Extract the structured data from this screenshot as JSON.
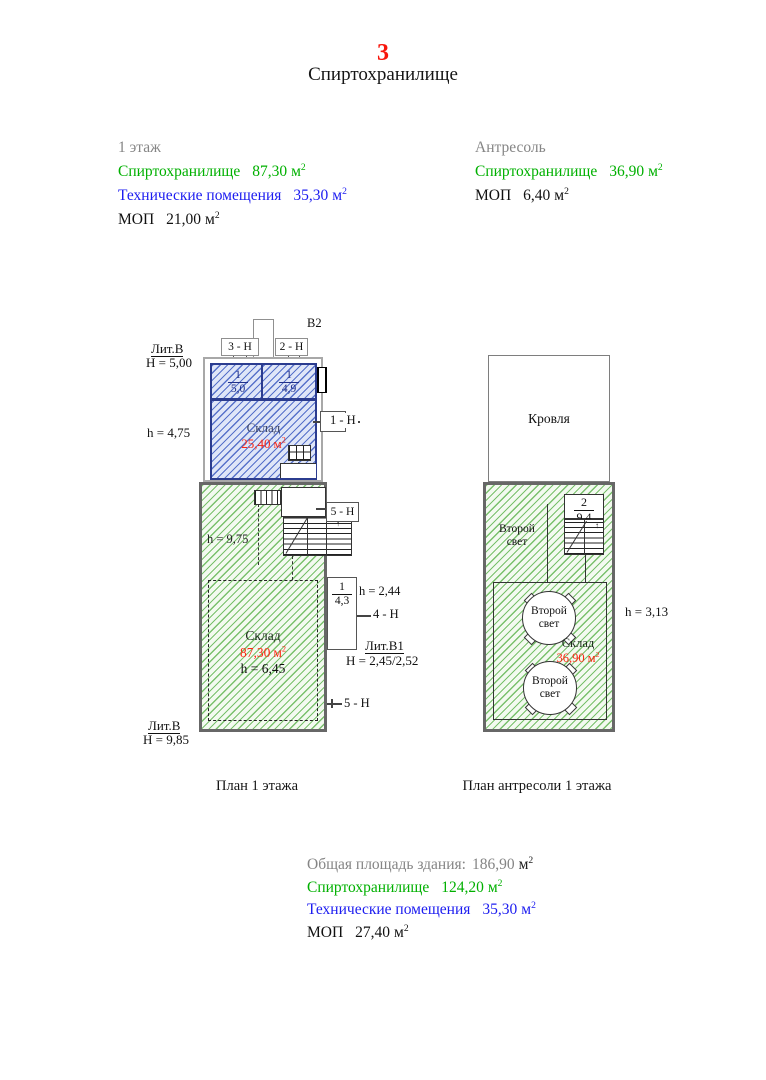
{
  "colors": {
    "accent_green": "#00b000",
    "accent_blue": "#1c1cf0",
    "accent_red": "#ff2613",
    "page_number_red": "#f8150b",
    "muted_gray": "#858585",
    "plan_blue": "#2b3c8f"
  },
  "header": {
    "page_number": "3",
    "title": "Спиртохранилище"
  },
  "units": {
    "base": "м",
    "sup": "2"
  },
  "legend_floor1": {
    "heading": "1 этаж",
    "alcohol_label": "Спиртохранилище",
    "alcohol_value": "87,30",
    "tech_label": "Технические помещения",
    "tech_value": "35,30",
    "mop_label": "МОП",
    "mop_value": "21,00"
  },
  "legend_mezzanine": {
    "heading": "Антресоль",
    "alcohol_label": "Спиртохранилище",
    "alcohol_value": "36,90",
    "mop_label": "МОП",
    "mop_value": "6,40"
  },
  "plan1": {
    "caption": "План 1 этажа",
    "vent": "В2",
    "lit_top_name": "Лит.В",
    "lit_top_h": "Н = 5,00",
    "h_left": "h = 4,75",
    "marker_3n": "3 - Н",
    "marker_2n": "2 - Н",
    "marker_1n": "1 - Н",
    "marker_5n_up": "5 - Н",
    "marker_4n": "4 - Н",
    "marker_5n_low": "5 - Н",
    "room1_num": "1",
    "room1_area": "5,0",
    "room2_num": "1",
    "room2_area": "4,9",
    "sklad_blue_name": "Склад",
    "sklad_blue_area": "25,40",
    "h_green": "h = 9,75",
    "sklad_green_name": "Склад",
    "sklad_green_area": "87,30",
    "sklad_green_h": "h = 6,45",
    "annex_num": "1",
    "annex_area": "4,3",
    "annex_h": "h = 2,44",
    "lit_b1_name": "Лит.В1",
    "lit_b1_h": "Н = 2,45/2,52",
    "lit_bottom_name": "Лит.В",
    "lit_bottom_h": "Н = 9,85"
  },
  "plan2": {
    "caption": "План антресоли 1 этажа",
    "roof": "Кровля",
    "stair_num": "2",
    "stair_area": "9,4",
    "second_light": "Второй свет",
    "sklad_name": "Склад",
    "sklad_area": "36,90",
    "h_right": "h = 3,13"
  },
  "summary": {
    "total_label": "Общая площадь здания:",
    "total_value": "186,90",
    "alcohol_label": "Спиртохранилище",
    "alcohol_value": "124,20",
    "tech_label": "Технические помещения",
    "tech_value": "35,30",
    "mop_label": "МОП",
    "mop_value": "27,40"
  }
}
